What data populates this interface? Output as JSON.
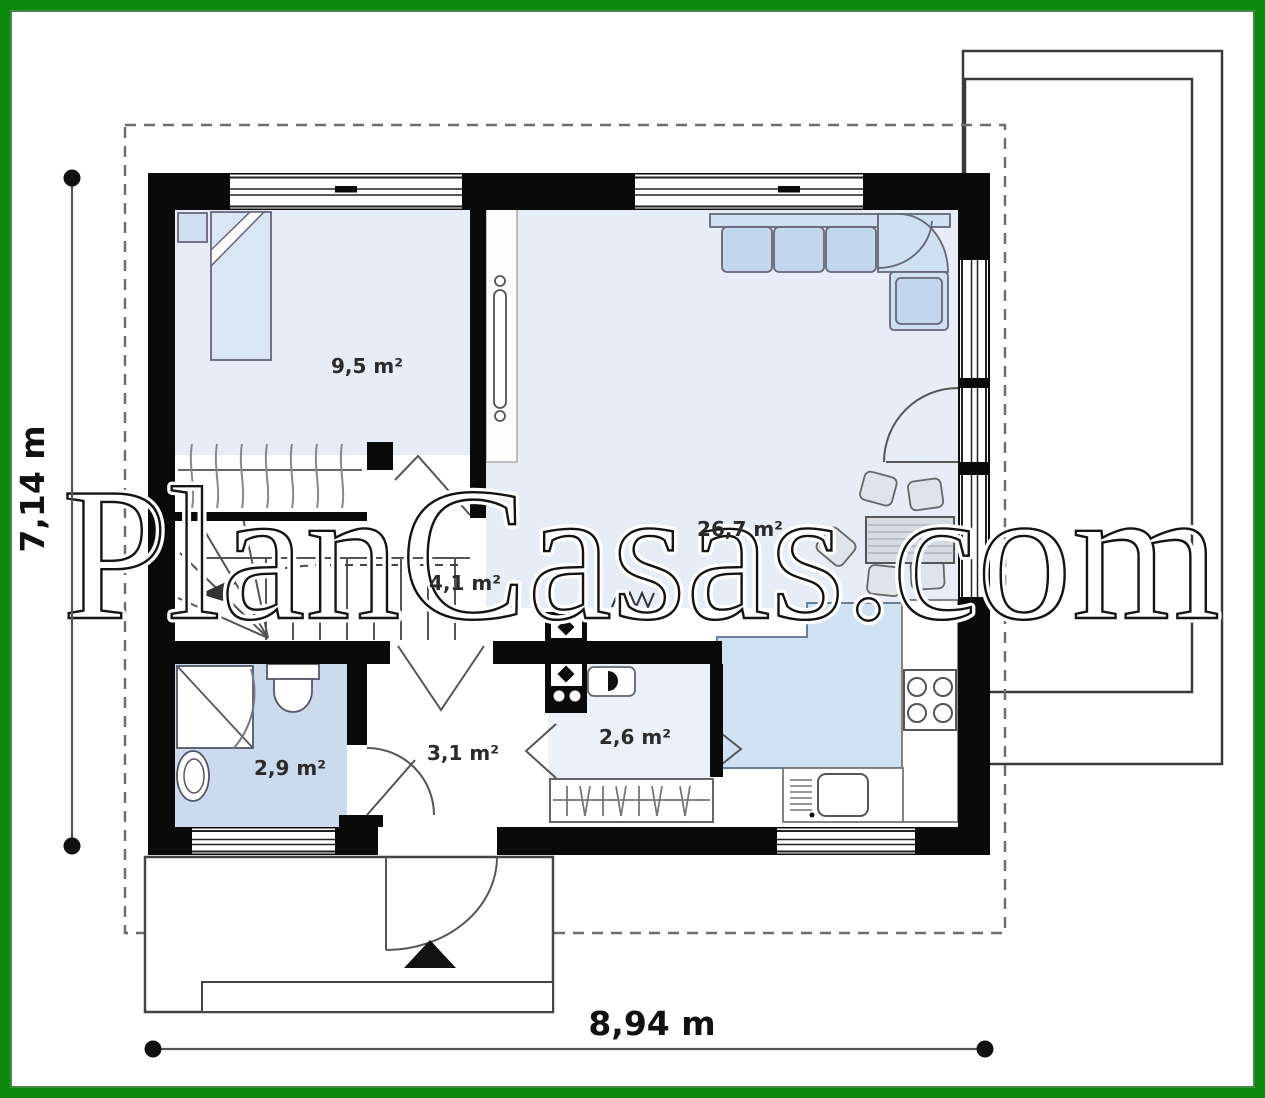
{
  "watermark": {
    "text": "PlanCasas.com"
  },
  "dimensions": {
    "width": {
      "label": "8,94 m"
    },
    "height": {
      "label": "7,14 m"
    }
  },
  "rooms": [
    {
      "id": "bedroom",
      "area": "9,5 m²"
    },
    {
      "id": "living-room",
      "area": "26,7 m²"
    },
    {
      "id": "staircase-hall",
      "area": "4,1 m²"
    },
    {
      "id": "hall",
      "area": "3,1 m²"
    },
    {
      "id": "bathroom",
      "area": "2,9 m²"
    },
    {
      "id": "pantry",
      "area": "2,6 m²"
    }
  ],
  "colors": {
    "frame_green": "#0d8a0d",
    "frame_green_dark": "#066306",
    "wall_black": "#0a0a0a",
    "room_fill": "#e7edf7",
    "bathroom_fill": "#ccdaed",
    "island_fill": "#cfe2f4",
    "furniture_fill": "#cfe0f3",
    "line_gray": "#555555"
  }
}
